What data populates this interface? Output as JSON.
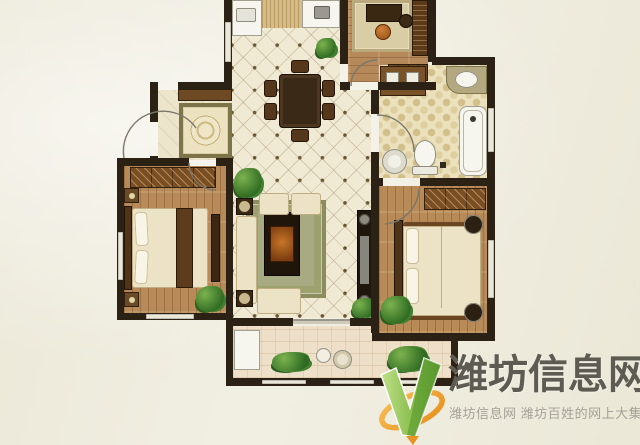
{
  "image_type": "real-estate floor plan photo with site watermark",
  "watermark": {
    "title": "潍坊信息网",
    "subtitle": "潍坊信息网 潍坊百姓的网上大集",
    "title_color": "#5d5b52",
    "subtitle_color": "#a5a196",
    "logo": {
      "name": "green-v-checkmark-with-orange-swoosh",
      "v_green_light": "#b8dd7f",
      "v_green_dark": "#5f9e33",
      "swoosh_orange": "#f2a237"
    }
  },
  "palette": {
    "background_marble": "#f1efe2",
    "walls": "#2b2114",
    "diamond_tile_floor": "#f0e9d3",
    "wood_floor": "#b78a57",
    "bathroom_floor": "#ece1bd",
    "balcony_floor": "#eedfc8",
    "bedding_cream": "#ece2c6",
    "furniture_dark_wood": "#3a2813",
    "plant_green": "#2f6b22"
  },
  "plan": {
    "rooms": [
      {
        "id": "kitchen",
        "features": [
          "white-counter",
          "sink",
          "prep-mat",
          "appliance-counter"
        ]
      },
      {
        "id": "dining-area",
        "features": [
          "dining-table",
          "six-chairs",
          "plant"
        ]
      },
      {
        "id": "study",
        "features": [
          "rug",
          "desk",
          "orange-chair",
          "bookshelf",
          "low-cabinet",
          "door"
        ]
      },
      {
        "id": "bathroom",
        "features": [
          "storage-cabinet",
          "corner-vanity-sink",
          "bathtub",
          "toilet",
          "washer",
          "floor-drain",
          "door"
        ]
      },
      {
        "id": "foyer",
        "features": [
          "entry-door",
          "shoe-cabinet",
          "medallion-rug"
        ]
      },
      {
        "id": "living-room",
        "features": [
          "sofa-set",
          "armchairs",
          "coffee-table",
          "area-rug",
          "corner-tables",
          "tv-cabinet",
          "plants",
          "balcony-sliding-door"
        ]
      },
      {
        "id": "bedroom-left",
        "features": [
          "wardrobe",
          "double-bed",
          "pillows",
          "foot-bench",
          "nightstands",
          "plant",
          "door"
        ]
      },
      {
        "id": "bedroom-master",
        "features": [
          "wardrobe",
          "double-bed",
          "pillows",
          "round-side-tables",
          "plant",
          "door"
        ]
      },
      {
        "id": "balcony",
        "features": [
          "white-cabinet",
          "plants",
          "small-table-set",
          "windows"
        ]
      }
    ]
  }
}
